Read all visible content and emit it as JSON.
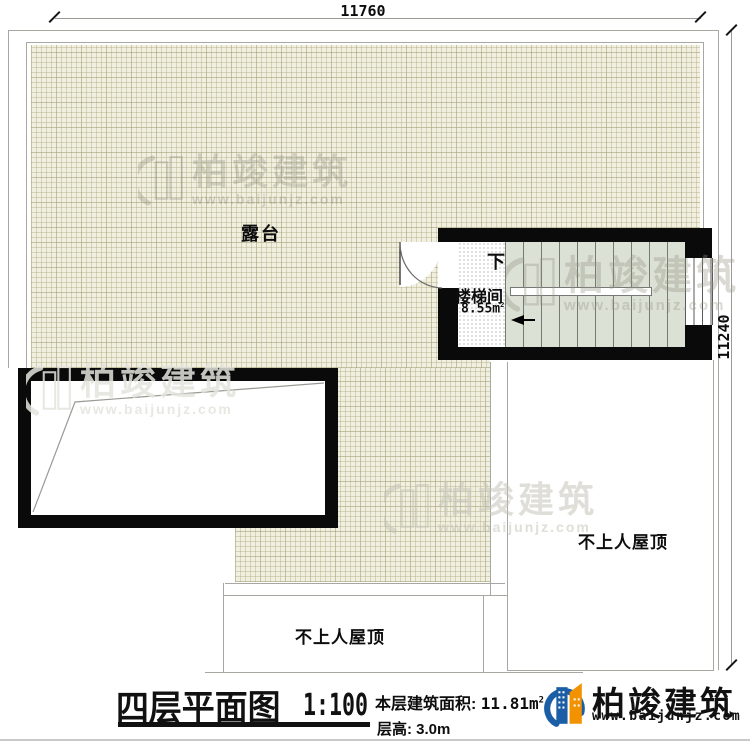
{
  "dimensions": {
    "top": "11760",
    "right": "11240"
  },
  "plan": {
    "terrace_label": "露台",
    "stair_room_label": "楼梯间",
    "stair_room_area": "8.55m",
    "stair_room_area_sup": "2",
    "stair_down_label": "下",
    "roof_label_right": "不上人屋顶",
    "roof_label_bottom": "不上人屋顶"
  },
  "watermark": {
    "brand": "柏竣建筑",
    "url": "www.baijunjz.com"
  },
  "titleblock": {
    "title": "四层平面图",
    "scale": "1:100",
    "area_label": "本层建筑面积:",
    "area_value": "11.81m",
    "area_sup": "2",
    "floor_height": "层高: 3.0m"
  },
  "logo": {
    "brand": "柏竣建筑",
    "url": "www.baijunjz.com"
  },
  "colors": {
    "wall": "#0a0a0a",
    "hatch_fill": "#f1efdf",
    "stair_fill": "#dbe1d5",
    "logo_blue": "#1b5ea6",
    "logo_orange": "#f29200",
    "line": "#a8a8a3"
  }
}
